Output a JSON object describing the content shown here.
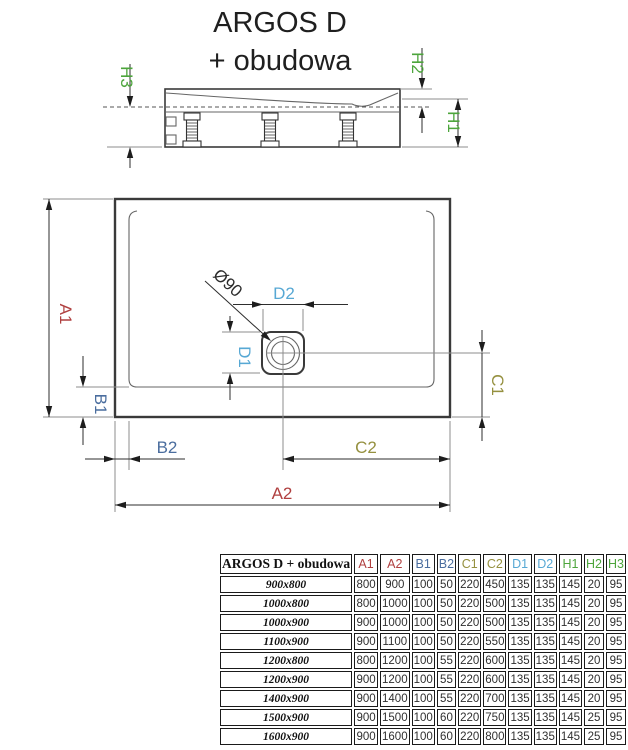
{
  "title": {
    "line1": "ARGOS D",
    "line2": "+ obudowa"
  },
  "drawing": {
    "labels": {
      "a1": "A1",
      "a2": "A2",
      "b1": "B1",
      "b2": "B2",
      "c1": "C1",
      "c2": "C2",
      "d1": "D1",
      "d2": "D2",
      "h1": "H1",
      "h2": "H2",
      "h3": "H3",
      "diameter": "Ø90"
    },
    "colors": {
      "red": "#b04040",
      "blue": "#4a6d9e",
      "olive": "#95903f",
      "cyan": "#57a8d4",
      "green": "#4da53c",
      "line": "#2e2e2e"
    }
  },
  "table": {
    "corner_label": "ARGOS D + obudowa",
    "columns": [
      {
        "label": "A1",
        "color": "#b04040"
      },
      {
        "label": "A2",
        "color": "#b04040"
      },
      {
        "label": "B1",
        "color": "#4a6d9e"
      },
      {
        "label": "B2",
        "color": "#4a6d9e"
      },
      {
        "label": "C1",
        "color": "#95903f"
      },
      {
        "label": "C2",
        "color": "#95903f"
      },
      {
        "label": "D1",
        "color": "#57a8d4"
      },
      {
        "label": "D2",
        "color": "#57a8d4"
      },
      {
        "label": "H1",
        "color": "#4da53c"
      },
      {
        "label": "H2",
        "color": "#4da53c"
      },
      {
        "label": "H3",
        "color": "#4da53c"
      }
    ],
    "rows": [
      {
        "size": "900x800",
        "values": [
          800,
          900,
          100,
          50,
          220,
          450,
          135,
          135,
          145,
          20,
          95
        ]
      },
      {
        "size": "1000x800",
        "values": [
          800,
          1000,
          100,
          50,
          220,
          500,
          135,
          135,
          145,
          20,
          95
        ]
      },
      {
        "size": "1000x900",
        "values": [
          900,
          1000,
          100,
          50,
          220,
          500,
          135,
          135,
          145,
          20,
          95
        ]
      },
      {
        "size": "1100x900",
        "values": [
          900,
          1100,
          100,
          50,
          220,
          550,
          135,
          135,
          145,
          20,
          95
        ]
      },
      {
        "size": "1200x800",
        "values": [
          800,
          1200,
          100,
          55,
          220,
          600,
          135,
          135,
          145,
          20,
          95
        ]
      },
      {
        "size": "1200x900",
        "values": [
          900,
          1200,
          100,
          55,
          220,
          600,
          135,
          135,
          145,
          20,
          95
        ]
      },
      {
        "size": "1400x900",
        "values": [
          900,
          1400,
          100,
          55,
          220,
          700,
          135,
          135,
          145,
          20,
          95
        ]
      },
      {
        "size": "1500x900",
        "values": [
          900,
          1500,
          100,
          60,
          220,
          750,
          135,
          135,
          145,
          25,
          95
        ]
      },
      {
        "size": "1600x900",
        "values": [
          900,
          1600,
          100,
          60,
          220,
          800,
          135,
          135,
          145,
          25,
          95
        ]
      }
    ]
  }
}
